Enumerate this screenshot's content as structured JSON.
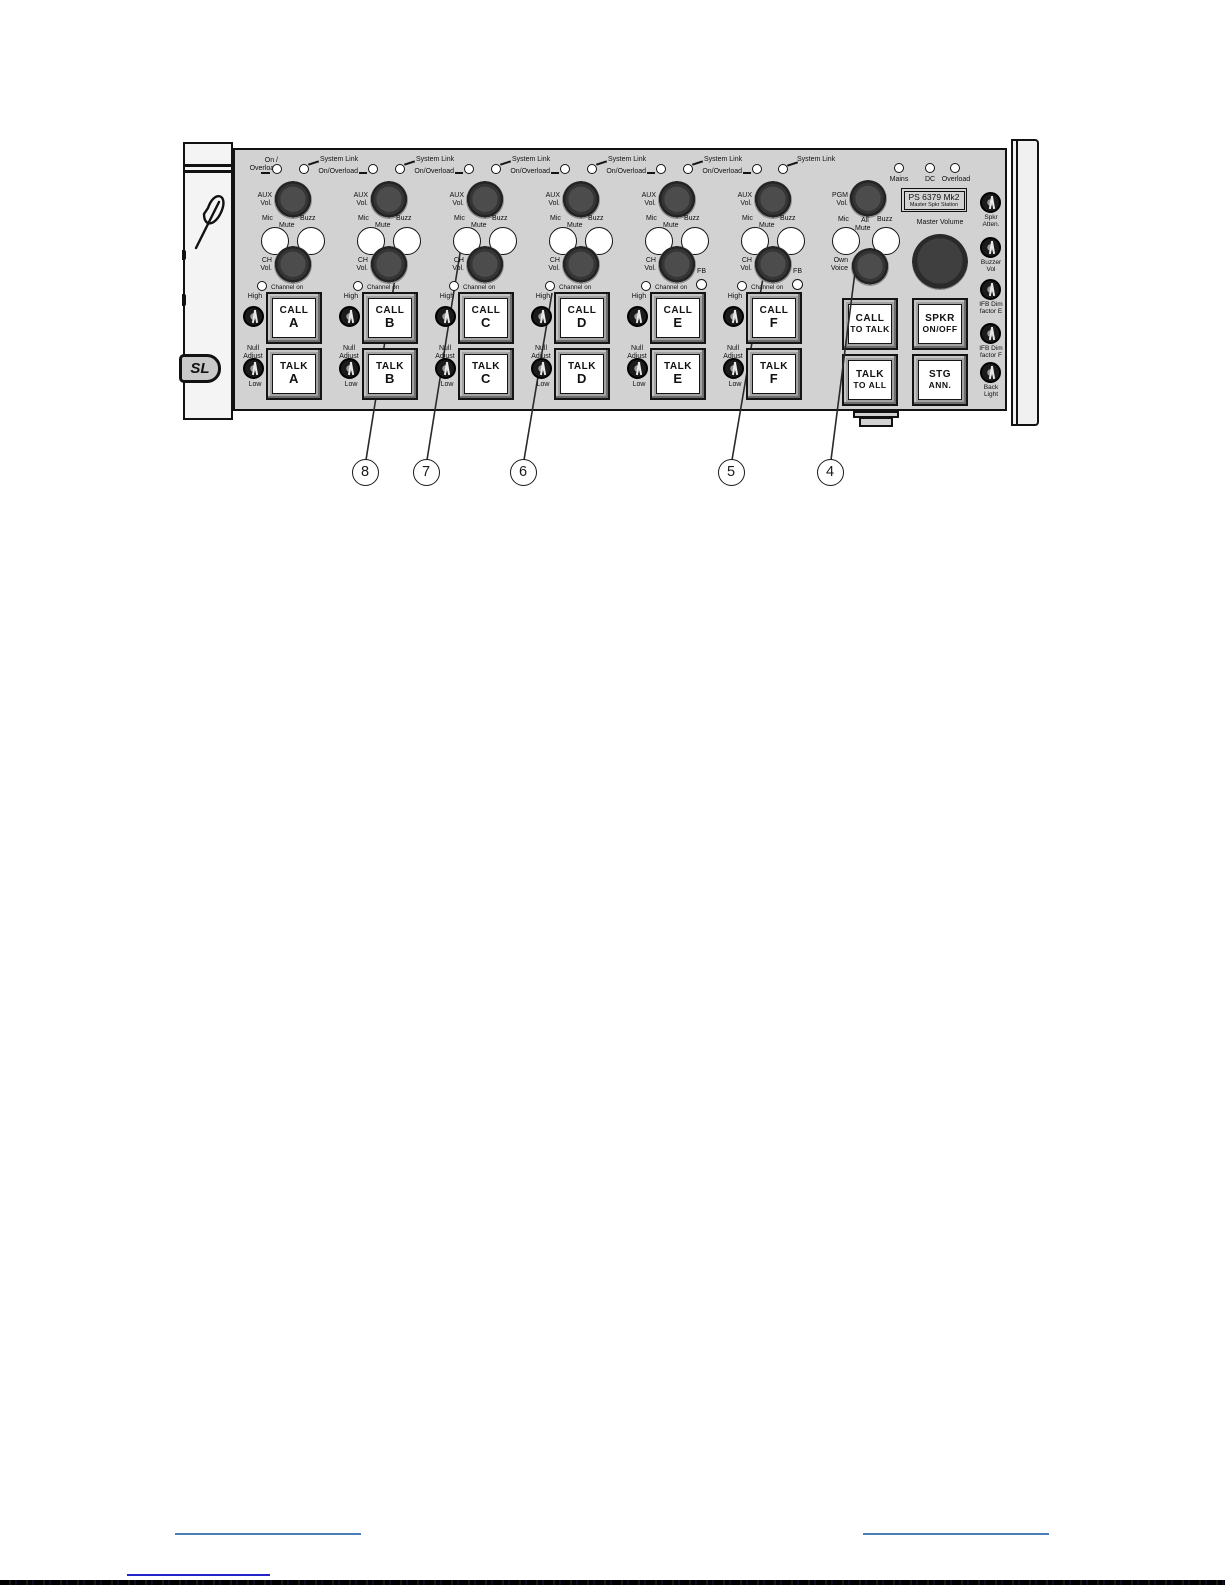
{
  "figure": {
    "logo_badge": "SL",
    "shared": {
      "aux1": "AUX",
      "aux2": "Vol.",
      "mic": "Mic",
      "mute": "Mute",
      "buzz": "Buzz",
      "ch1": "CH",
      "ch2": "Vol.",
      "channel_on": "Channel on",
      "fb": "FB",
      "high": "High",
      "null1": "Null",
      "null2": "Adjust",
      "low": "Low",
      "call": "CALL",
      "talk": "TALK",
      "system_link": "System Link",
      "on_overload": "On/Overload"
    },
    "channels": [
      {
        "letter": "A",
        "top1": "On /",
        "top2": "Overload",
        "fb": false
      },
      {
        "letter": "B",
        "fb": false
      },
      {
        "letter": "C",
        "fb": false
      },
      {
        "letter": "D",
        "fb": false
      },
      {
        "letter": "E",
        "fb": true
      },
      {
        "letter": "F",
        "fb": true
      }
    ],
    "master": {
      "system_link": "System Link",
      "leds": {
        "mains": "Mains",
        "dc": "DC",
        "overload": "Overload"
      },
      "pgm": {
        "line1": "PGM",
        "line2": "Vol."
      },
      "model": {
        "line1": "PS 6379 Mk2",
        "line2": "Master Spkr Station"
      },
      "mic": "Mic",
      "all": "All",
      "mute": "Mute",
      "buzz": "Buzz",
      "master_volume": "Master Volume",
      "own": {
        "line1": "Own",
        "line2": "Voice"
      },
      "buttons": {
        "call_to_talk": {
          "line1": "CALL",
          "line2": "TO TALK"
        },
        "talk_to_all": {
          "line1": "TALK",
          "line2": "TO ALL"
        },
        "spkr": {
          "line1": "SPKR",
          "line2": "ON/OFF"
        },
        "stg": {
          "line1": "STG",
          "line2": "ANN."
        }
      }
    },
    "trims": [
      {
        "line1": "Spkr",
        "line2": "Atten."
      },
      {
        "line1": "Buzzer",
        "line2": "Vol"
      },
      {
        "line1": "IFB Dim",
        "line2": "factor E"
      },
      {
        "line1": "IFB Dim",
        "line2": "factor F"
      },
      {
        "line1": "Back",
        "line2": "Light"
      }
    ],
    "callouts": [
      "8",
      "7",
      "6",
      "5",
      "4"
    ]
  },
  "colors": {
    "panel_gray": "#d2d2d2",
    "rule_blue": "#4a7eb5",
    "link_blue": "#2424cc",
    "ink": "#111111"
  }
}
